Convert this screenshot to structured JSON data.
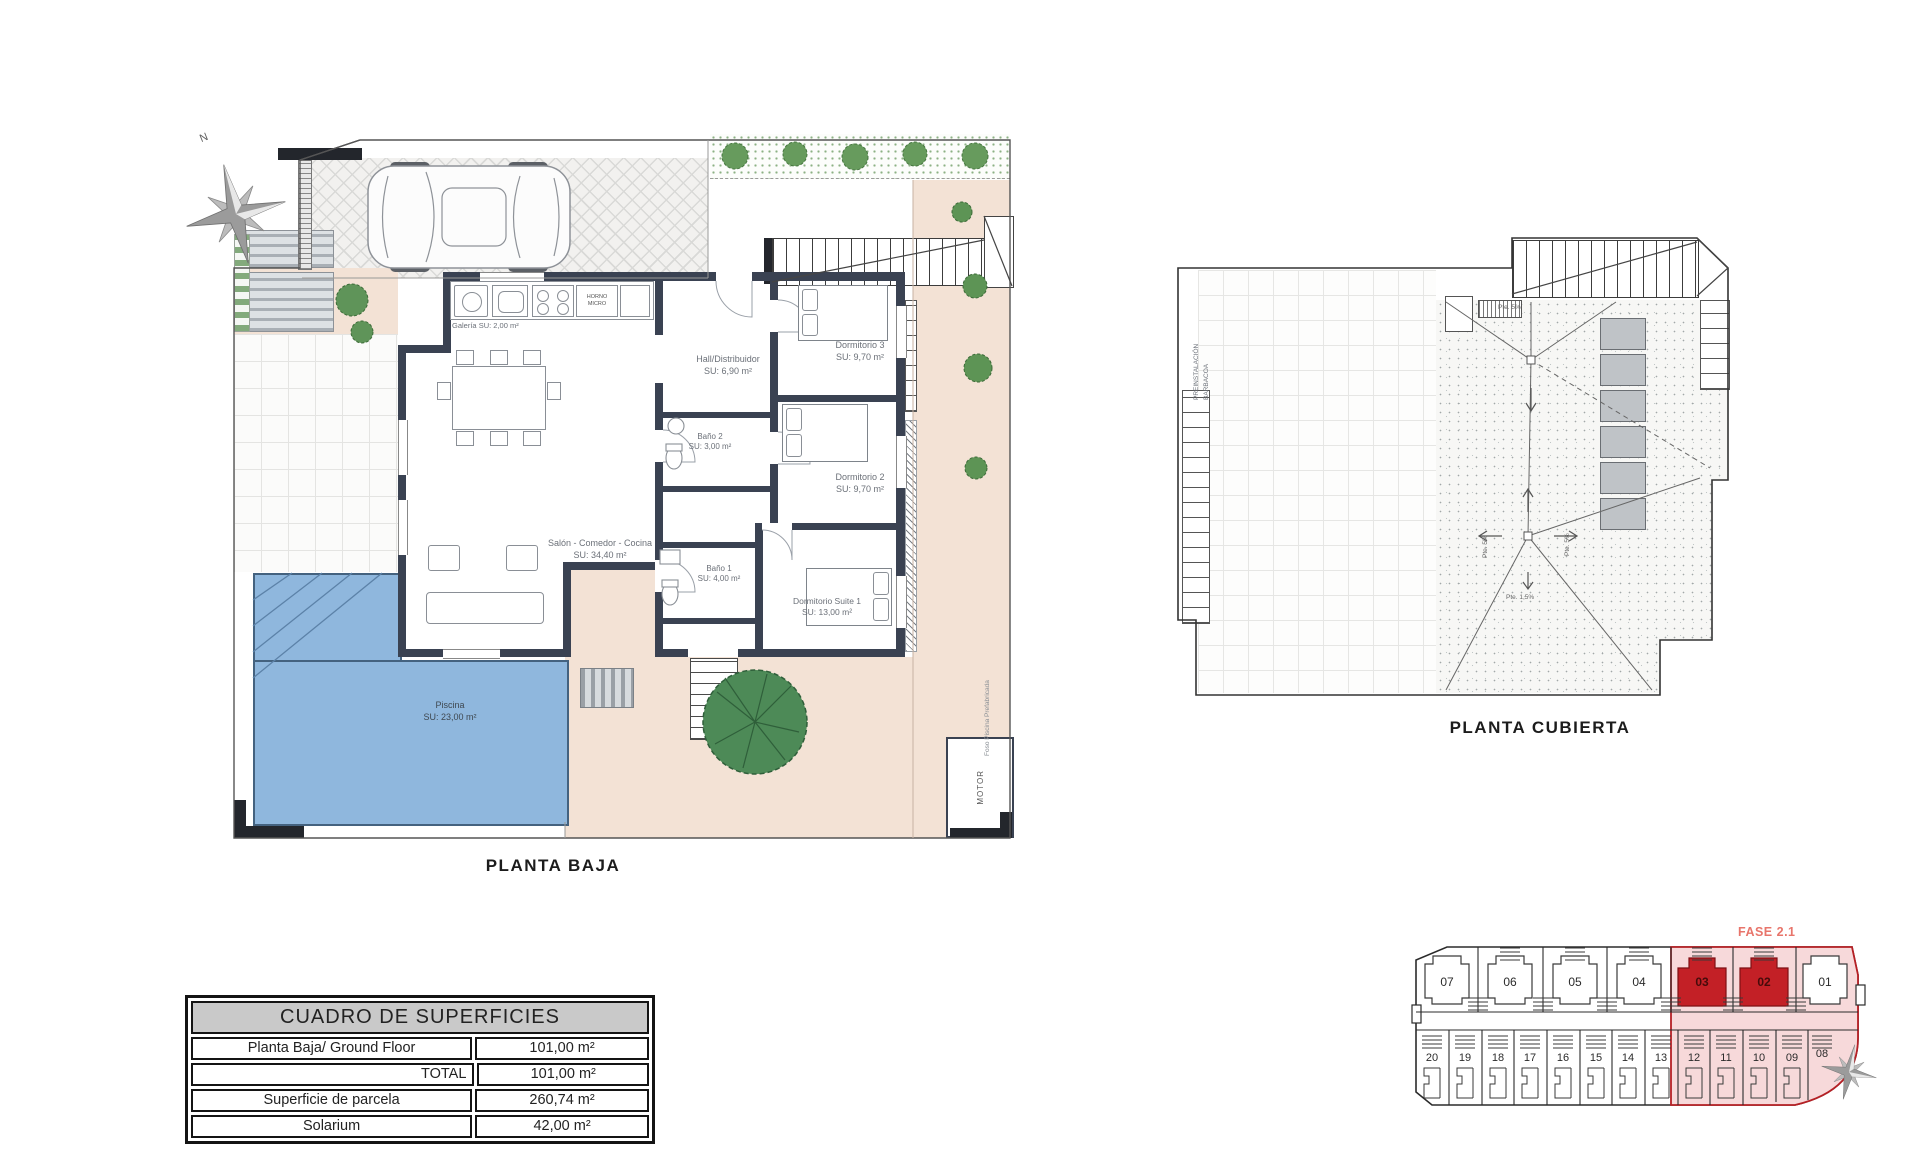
{
  "document": {
    "background": "#ffffff"
  },
  "colors": {
    "wall": "#3a4252",
    "pool_fill": "#8fb7dd",
    "pool_border": "#44627f",
    "terrace_pink": "#f3e2d5",
    "hedge_green": "#679b5d",
    "site_zone_fill": "#f7d9da",
    "site_zone_border": "#b52025",
    "site_unit_highlight": "#c32026",
    "phase_text": "#e8756b",
    "table_header_bg": "#c9c9c9"
  },
  "ground_floor": {
    "title": "PLANTA BAJA",
    "compass_label": "N",
    "rooms": {
      "galeria": {
        "name": "Galería",
        "area": "SU: 2,00 m²"
      },
      "salon": {
        "name": "Salón - Comedor - Cocina",
        "area": "SU: 34,40 m²"
      },
      "hall": {
        "name": "Hall/Distribuidor",
        "area": "SU: 6,90 m²"
      },
      "bano2": {
        "name": "Baño 2",
        "area": "SU: 3,00 m²"
      },
      "bano1": {
        "name": "Baño 1",
        "area": "SU: 4,00 m²"
      },
      "dorm3": {
        "name": "Dormitorio 3",
        "area": "SU: 9,70 m²"
      },
      "dorm2": {
        "name": "Dormitorio 2",
        "area": "SU: 9,70 m²"
      },
      "suite": {
        "name": "Dormitorio Suite 1",
        "area": "SU: 13,00 m²"
      },
      "piscina": {
        "name": "Piscina",
        "area": "SU: 23,00 m²"
      }
    },
    "kitchen_labels": {
      "horno": "HORNO MICRO"
    },
    "annotations": {
      "motor": "MOTOR",
      "foso": "Foso Piscina Prefabricada"
    }
  },
  "roof": {
    "title": "PLANTA CUBIERTA",
    "annotations": {
      "barbacoa": "PREINSTALACIÓN\nBARBACOA",
      "slope_top": "Pte. 5%",
      "slope_left": "Pte. 5%",
      "slope_right": "Pte. 5%",
      "slope_bottom": "Pte. 1,5%"
    }
  },
  "surface_table": {
    "title": "CUADRO DE SUPERFICIES",
    "rows": [
      {
        "label": "Planta Baja/ Ground Floor",
        "value": "101,00 m²"
      },
      {
        "label": "TOTAL",
        "value": "101,00 m²"
      },
      {
        "label": "Superficie de parcela",
        "value": "260,74 m²"
      },
      {
        "label": "Solarium",
        "value": "42,00 m²"
      }
    ]
  },
  "site_plan": {
    "phase": "FASE 2.1",
    "top_units": [
      "07",
      "06",
      "05",
      "04",
      "03",
      "02",
      "01"
    ],
    "bottom_units": [
      "20",
      "19",
      "18",
      "17",
      "16",
      "15",
      "14",
      "13",
      "12",
      "11",
      "10",
      "09",
      "08"
    ],
    "highlighted_units": [
      "03",
      "02"
    ]
  }
}
